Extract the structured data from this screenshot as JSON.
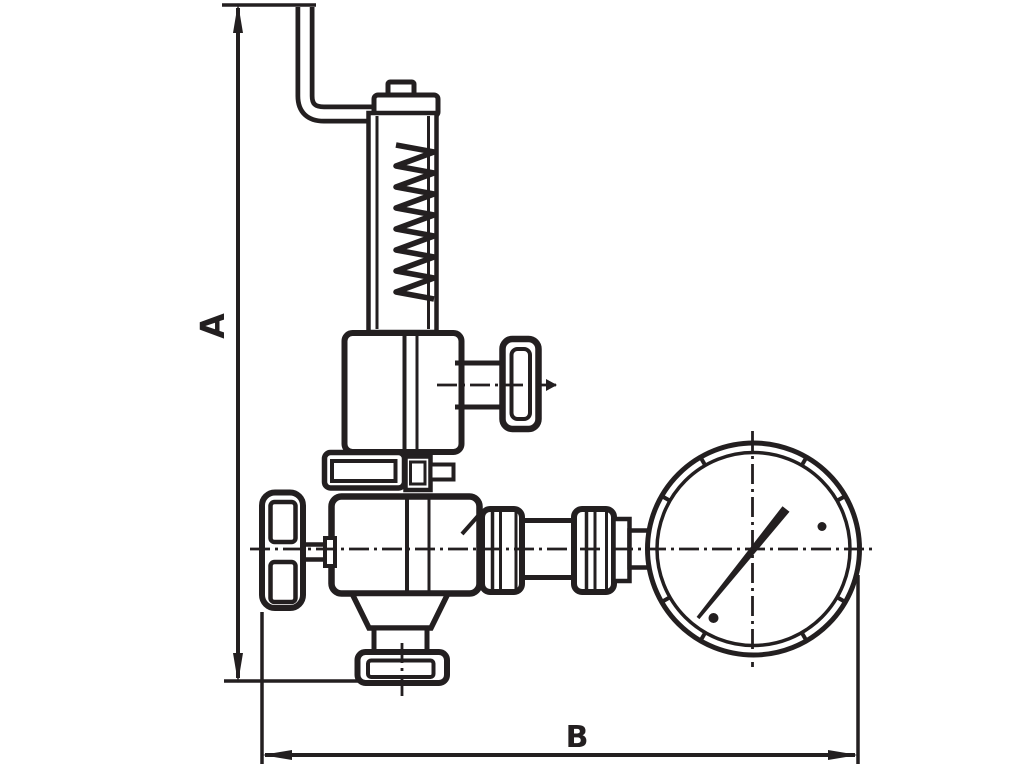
{
  "figure": {
    "type": "dimensioned-technical-line-drawing",
    "subject": "safety valve assembly with easing lever, spring bonnet, shut-off handwheel, piping and pressure gauge",
    "components": [
      "easing-lever",
      "lever-knob",
      "spring-cap",
      "spring-housing",
      "spring-coil",
      "bonnet",
      "side-outlet-pipe",
      "side-outlet-handwheel",
      "union-nut",
      "valve-body",
      "outlet-neck",
      "outlet-flange",
      "shutoff-handwheel",
      "pipe-fittings",
      "pressure-gauge",
      "gauge-needle"
    ]
  },
  "dimensions": {
    "a_label": "A",
    "b_label": "B"
  },
  "colors": {
    "line": "#231f20",
    "background": "#ffffff"
  }
}
